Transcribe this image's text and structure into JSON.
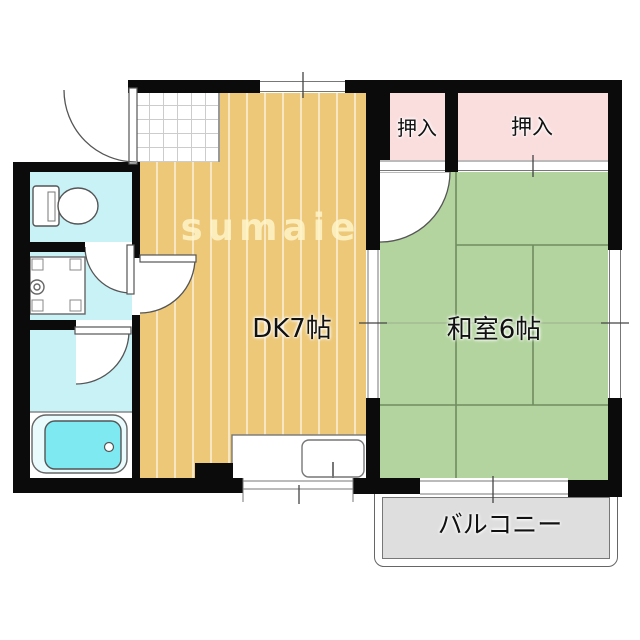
{
  "plan": {
    "type": "floorplan",
    "watermark": "sumaie",
    "rooms": {
      "dk": {
        "label": "DK7帖",
        "tatami": 7
      },
      "washitsu": {
        "label": "和室6帖",
        "tatami": 6
      },
      "closet_left": {
        "label": "押入"
      },
      "closet_right": {
        "label": "押入"
      },
      "balcony": {
        "label": "バルコニー"
      }
    },
    "fixtures": [
      "toilet",
      "washing-machine-pan",
      "bathtub",
      "kitchen-sink-counter",
      "entrance-door",
      "hinged-door",
      "sliding-window",
      "tatami-grid",
      "tile-entry"
    ],
    "colors": {
      "wood_floor": "#ECC878",
      "wood_floor_stripe": "#F8E9BD",
      "tatami_green": "#B3D49E",
      "tatami_line": "#6F8C5F",
      "closet_pink": "#FADEDE",
      "wet_area_cyan": "#C9F2F7",
      "bathtub_cyan": "#7FE9F2",
      "balcony_gray": "#DEDEDE",
      "wall_black": "#0B0B0B",
      "watermark_cream": "rgba(255,243,200,0.85)"
    }
  }
}
